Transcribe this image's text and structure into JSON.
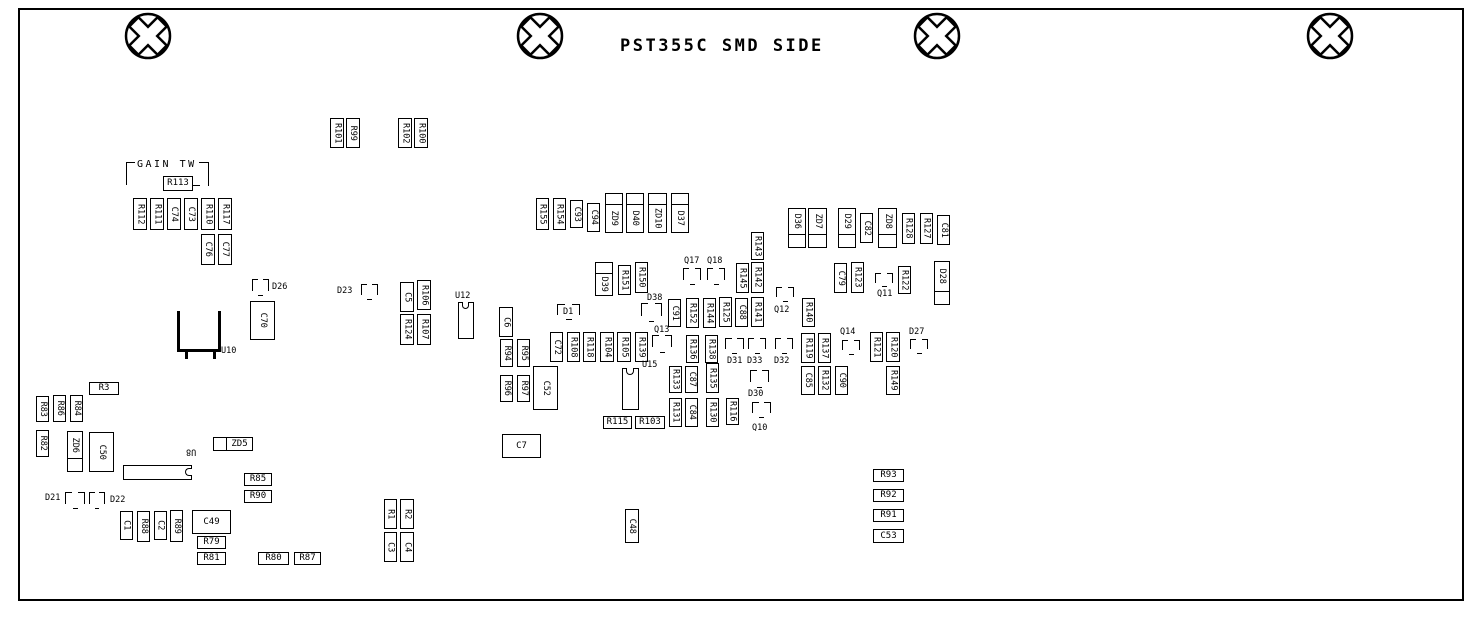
{
  "title": "PST355C SMD SIDE",
  "screws": [
    {
      "cx": 148,
      "cy": 36
    },
    {
      "cx": 540,
      "cy": 36
    },
    {
      "cx": 937,
      "cy": 36
    },
    {
      "cx": 1330,
      "cy": 36
    }
  ],
  "annotations": {
    "gain_tw": "GAIN TW"
  },
  "components": [
    {
      "t": "txt",
      "label": "GAIN TW",
      "x": 137,
      "y": 160,
      "fs": 10,
      "ls": 2.5
    },
    {
      "t": "cl",
      "ref": "gain-tw-bracket-left",
      "x": 126,
      "y": 162,
      "w": 9,
      "h": 23
    },
    {
      "t": "cr",
      "ref": "gain-tw-bracket-right",
      "x": 199,
      "y": 162,
      "w": 10,
      "h": 24
    },
    {
      "t": "ln",
      "ref": "gain-tw-bracket-arm",
      "x": 192,
      "y": 185,
      "w": 8,
      "h": 1
    },
    {
      "t": "bh",
      "label": "R113",
      "x": 163,
      "y": 176,
      "w": 30,
      "h": 15
    },
    {
      "t": "bv",
      "label": "R101",
      "x": 330,
      "y": 118,
      "w": 14,
      "h": 30
    },
    {
      "t": "bv",
      "label": "R99",
      "x": 346,
      "y": 118,
      "w": 14,
      "h": 30
    },
    {
      "t": "bv",
      "label": "R102",
      "x": 398,
      "y": 118,
      "w": 14,
      "h": 30
    },
    {
      "t": "bv",
      "label": "R100",
      "x": 414,
      "y": 118,
      "w": 14,
      "h": 30
    },
    {
      "t": "bv",
      "label": "R112",
      "x": 133,
      "y": 198,
      "w": 14,
      "h": 32
    },
    {
      "t": "bv",
      "label": "R111",
      "x": 150,
      "y": 198,
      "w": 14,
      "h": 32
    },
    {
      "t": "bv",
      "label": "C74",
      "x": 167,
      "y": 198,
      "w": 14,
      "h": 32
    },
    {
      "t": "bv",
      "label": "C73",
      "x": 184,
      "y": 198,
      "w": 14,
      "h": 32
    },
    {
      "t": "bv",
      "label": "R110",
      "x": 201,
      "y": 198,
      "w": 14,
      "h": 32
    },
    {
      "t": "bv",
      "label": "R117",
      "x": 218,
      "y": 198,
      "w": 14,
      "h": 32
    },
    {
      "t": "bv",
      "label": "C76",
      "x": 201,
      "y": 234,
      "w": 14,
      "h": 31
    },
    {
      "t": "bv",
      "label": "C77",
      "x": 218,
      "y": 234,
      "w": 14,
      "h": 31
    },
    {
      "t": "brk",
      "ref": "D26",
      "x": 252,
      "y": 279,
      "w": 17,
      "h": 17
    },
    {
      "t": "txt",
      "label": "D26",
      "x": 272,
      "y": 283
    },
    {
      "t": "bv",
      "label": "C70",
      "x": 250,
      "y": 301,
      "w": 25,
      "h": 39
    },
    {
      "t": "u10",
      "ref": "U10",
      "x": 177,
      "y": 311,
      "w": 44,
      "h": 41
    },
    {
      "t": "txt",
      "label": "U10",
      "x": 221,
      "y": 347
    },
    {
      "t": "txt",
      "label": "D23",
      "x": 337,
      "y": 287
    },
    {
      "t": "brk",
      "ref": "D23",
      "x": 361,
      "y": 284,
      "w": 17,
      "h": 16
    },
    {
      "t": "bv",
      "label": "C5",
      "x": 400,
      "y": 282,
      "w": 14,
      "h": 30
    },
    {
      "t": "bv",
      "label": "R106",
      "x": 417,
      "y": 280,
      "w": 14,
      "h": 30
    },
    {
      "t": "bv",
      "label": "R124",
      "x": 400,
      "y": 314,
      "w": 14,
      "h": 31
    },
    {
      "t": "bv",
      "label": "R107",
      "x": 417,
      "y": 314,
      "w": 14,
      "h": 31
    },
    {
      "t": "txt",
      "label": "U12",
      "x": 455,
      "y": 292
    },
    {
      "t": "icV",
      "ref": "U12",
      "x": 458,
      "y": 302,
      "w": 16,
      "h": 37
    },
    {
      "t": "bh",
      "label": "R3",
      "x": 89,
      "y": 382,
      "w": 30,
      "h": 13
    },
    {
      "t": "bv",
      "label": "R83",
      "x": 36,
      "y": 396,
      "w": 13,
      "h": 26
    },
    {
      "t": "bv",
      "label": "R86",
      "x": 53,
      "y": 395,
      "w": 13,
      "h": 27
    },
    {
      "t": "bv",
      "label": "R84",
      "x": 70,
      "y": 395,
      "w": 13,
      "h": 27
    },
    {
      "t": "bv",
      "label": "R82",
      "x": 36,
      "y": 430,
      "w": 13,
      "h": 27
    },
    {
      "t": "dv",
      "label": "ZD6",
      "x": 67,
      "y": 431,
      "w": 16,
      "h": 41
    },
    {
      "t": "bv",
      "label": "C50",
      "x": 89,
      "y": 432,
      "w": 25,
      "h": 40
    },
    {
      "t": "icH",
      "ref": "U8",
      "x": 123,
      "y": 465,
      "w": 69,
      "h": 15
    },
    {
      "t": "txtv",
      "label": "U8",
      "x": 186,
      "y": 447
    },
    {
      "t": "dh",
      "label": "ZD5",
      "x": 213,
      "y": 437,
      "w": 40,
      "h": 14
    },
    {
      "t": "txt",
      "label": "D21",
      "x": 45,
      "y": 494
    },
    {
      "t": "brk",
      "ref": "D21",
      "x": 65,
      "y": 492,
      "w": 20,
      "h": 17
    },
    {
      "t": "brk",
      "ref": "D22",
      "x": 89,
      "y": 492,
      "w": 16,
      "h": 17
    },
    {
      "t": "txt",
      "label": "D22",
      "x": 110,
      "y": 496
    },
    {
      "t": "bv",
      "label": "C1",
      "x": 120,
      "y": 511,
      "w": 13,
      "h": 29
    },
    {
      "t": "bv",
      "label": "R88",
      "x": 137,
      "y": 511,
      "w": 13,
      "h": 31
    },
    {
      "t": "bv",
      "label": "C2",
      "x": 154,
      "y": 511,
      "w": 13,
      "h": 29
    },
    {
      "t": "bv",
      "label": "R89",
      "x": 170,
      "y": 510,
      "w": 13,
      "h": 32
    },
    {
      "t": "bh",
      "label": "C49",
      "x": 192,
      "y": 510,
      "w": 39,
      "h": 24
    },
    {
      "t": "bh",
      "label": "R79",
      "x": 197,
      "y": 536,
      "w": 29,
      "h": 13
    },
    {
      "t": "bh",
      "label": "R81",
      "x": 197,
      "y": 552,
      "w": 29,
      "h": 13
    },
    {
      "t": "bh",
      "label": "R80",
      "x": 258,
      "y": 552,
      "w": 31,
      "h": 13
    },
    {
      "t": "bh",
      "label": "R87",
      "x": 294,
      "y": 552,
      "w": 27,
      "h": 13
    },
    {
      "t": "bh",
      "label": "R85",
      "x": 244,
      "y": 473,
      "w": 28,
      "h": 13
    },
    {
      "t": "bh",
      "label": "R90",
      "x": 244,
      "y": 490,
      "w": 28,
      "h": 13
    },
    {
      "t": "bv",
      "label": "R1",
      "x": 384,
      "y": 499,
      "w": 13,
      "h": 30
    },
    {
      "t": "bv",
      "label": "R2",
      "x": 400,
      "y": 499,
      "w": 14,
      "h": 30
    },
    {
      "t": "bv",
      "label": "C3",
      "x": 384,
      "y": 532,
      "w": 13,
      "h": 30
    },
    {
      "t": "bv",
      "label": "C4",
      "x": 400,
      "y": 532,
      "w": 14,
      "h": 30
    },
    {
      "t": "bh",
      "label": "C7",
      "x": 502,
      "y": 434,
      "w": 39,
      "h": 24
    },
    {
      "t": "bv",
      "label": "C48",
      "x": 625,
      "y": 509,
      "w": 14,
      "h": 34
    },
    {
      "t": "bv",
      "label": "R155",
      "x": 536,
      "y": 198,
      "w": 13,
      "h": 32
    },
    {
      "t": "bv",
      "label": "R154",
      "x": 553,
      "y": 198,
      "w": 13,
      "h": 32
    },
    {
      "t": "bv",
      "label": "C93",
      "x": 570,
      "y": 200,
      "w": 13,
      "h": 28
    },
    {
      "t": "bv",
      "label": "C94",
      "x": 587,
      "y": 203,
      "w": 13,
      "h": 29
    },
    {
      "t": "dvb",
      "label": "ZD9",
      "x": 605,
      "y": 193,
      "w": 18,
      "h": 40
    },
    {
      "t": "dvb",
      "label": "D40",
      "x": 626,
      "y": 193,
      "w": 18,
      "h": 40
    },
    {
      "t": "dvb",
      "label": "ZD10",
      "x": 648,
      "y": 193,
      "w": 19,
      "h": 40
    },
    {
      "t": "dvb",
      "label": "D37",
      "x": 671,
      "y": 193,
      "w": 18,
      "h": 40
    },
    {
      "t": "dvb",
      "label": "D39",
      "x": 595,
      "y": 262,
      "w": 18,
      "h": 34
    },
    {
      "t": "bv",
      "label": "R151",
      "x": 618,
      "y": 265,
      "w": 13,
      "h": 30
    },
    {
      "t": "bv",
      "label": "R150",
      "x": 635,
      "y": 262,
      "w": 13,
      "h": 31
    },
    {
      "t": "txt",
      "label": "D38",
      "x": 647,
      "y": 294
    },
    {
      "t": "brk",
      "ref": "D38",
      "x": 641,
      "y": 303,
      "w": 21,
      "h": 19
    },
    {
      "t": "txt",
      "label": "Q17",
      "x": 684,
      "y": 257
    },
    {
      "t": "brk",
      "ref": "Q17",
      "x": 683,
      "y": 268,
      "w": 18,
      "h": 17
    },
    {
      "t": "txt",
      "label": "Q18",
      "x": 707,
      "y": 257
    },
    {
      "t": "brk",
      "ref": "Q18",
      "x": 707,
      "y": 268,
      "w": 18,
      "h": 17
    },
    {
      "t": "bv",
      "label": "C91",
      "x": 668,
      "y": 299,
      "w": 13,
      "h": 28
    },
    {
      "t": "bv",
      "label": "R152",
      "x": 686,
      "y": 298,
      "w": 13,
      "h": 30
    },
    {
      "t": "bv",
      "label": "R144",
      "x": 703,
      "y": 298,
      "w": 13,
      "h": 30
    },
    {
      "t": "bv",
      "label": "R125",
      "x": 719,
      "y": 297,
      "w": 13,
      "h": 30
    },
    {
      "t": "bv",
      "label": "C88",
      "x": 735,
      "y": 298,
      "w": 13,
      "h": 29
    },
    {
      "t": "bv",
      "label": "R141",
      "x": 751,
      "y": 297,
      "w": 13,
      "h": 30
    },
    {
      "t": "bv",
      "label": "R143",
      "x": 751,
      "y": 232,
      "w": 13,
      "h": 28
    },
    {
      "t": "bv",
      "label": "R145",
      "x": 736,
      "y": 263,
      "w": 13,
      "h": 30
    },
    {
      "t": "bv",
      "label": "R142",
      "x": 751,
      "y": 262,
      "w": 13,
      "h": 31
    },
    {
      "t": "brk",
      "ref": "Q12",
      "x": 776,
      "y": 287,
      "w": 18,
      "h": 15
    },
    {
      "t": "txt",
      "label": "Q12",
      "x": 774,
      "y": 306
    },
    {
      "t": "bv",
      "label": "R140",
      "x": 802,
      "y": 298,
      "w": 13,
      "h": 29
    },
    {
      "t": "bv",
      "label": "C79",
      "x": 834,
      "y": 263,
      "w": 13,
      "h": 30
    },
    {
      "t": "bv",
      "label": "R123",
      "x": 851,
      "y": 262,
      "w": 13,
      "h": 31
    },
    {
      "t": "brk",
      "ref": "Q11",
      "x": 875,
      "y": 273,
      "w": 18,
      "h": 14
    },
    {
      "t": "txt",
      "label": "Q11",
      "x": 877,
      "y": 290
    },
    {
      "t": "bv",
      "label": "R122",
      "x": 898,
      "y": 266,
      "w": 13,
      "h": 28
    },
    {
      "t": "dv",
      "label": "D28",
      "x": 934,
      "y": 261,
      "w": 16,
      "h": 44
    },
    {
      "t": "dv",
      "label": "D36",
      "x": 788,
      "y": 208,
      "w": 18,
      "h": 40
    },
    {
      "t": "dv",
      "label": "ZD7",
      "x": 808,
      "y": 208,
      "w": 19,
      "h": 40
    },
    {
      "t": "dv",
      "label": "D29",
      "x": 838,
      "y": 208,
      "w": 18,
      "h": 40
    },
    {
      "t": "bv",
      "label": "C82",
      "x": 860,
      "y": 213,
      "w": 13,
      "h": 30
    },
    {
      "t": "dv",
      "label": "ZD8",
      "x": 878,
      "y": 208,
      "w": 19,
      "h": 40
    },
    {
      "t": "bv",
      "label": "R128",
      "x": 902,
      "y": 213,
      "w": 13,
      "h": 31
    },
    {
      "t": "bv",
      "label": "R127",
      "x": 920,
      "y": 213,
      "w": 13,
      "h": 31
    },
    {
      "t": "bv",
      "label": "C81",
      "x": 937,
      "y": 215,
      "w": 13,
      "h": 30
    },
    {
      "t": "bv",
      "label": "C6",
      "x": 499,
      "y": 307,
      "w": 14,
      "h": 30
    },
    {
      "t": "brk",
      "ref": "D1",
      "x": 557,
      "y": 304,
      "w": 23,
      "h": 16
    },
    {
      "t": "txt",
      "label": "D1",
      "x": 563,
      "y": 308
    },
    {
      "t": "bv",
      "label": "R94",
      "x": 500,
      "y": 339,
      "w": 13,
      "h": 28
    },
    {
      "t": "bv",
      "label": "R95",
      "x": 517,
      "y": 339,
      "w": 13,
      "h": 28
    },
    {
      "t": "bv",
      "label": "R96",
      "x": 500,
      "y": 375,
      "w": 13,
      "h": 27
    },
    {
      "t": "bv",
      "label": "R97",
      "x": 517,
      "y": 375,
      "w": 13,
      "h": 27
    },
    {
      "t": "bv",
      "label": "C72",
      "x": 550,
      "y": 332,
      "w": 13,
      "h": 30
    },
    {
      "t": "bv",
      "label": "R108",
      "x": 567,
      "y": 332,
      "w": 13,
      "h": 30
    },
    {
      "t": "bv",
      "label": "R118",
      "x": 583,
      "y": 332,
      "w": 13,
      "h": 30
    },
    {
      "t": "bv",
      "label": "R104",
      "x": 600,
      "y": 332,
      "w": 14,
      "h": 30
    },
    {
      "t": "bv",
      "label": "R105",
      "x": 617,
      "y": 332,
      "w": 14,
      "h": 30
    },
    {
      "t": "bv",
      "label": "R139",
      "x": 635,
      "y": 332,
      "w": 13,
      "h": 30
    },
    {
      "t": "bv",
      "label": "C52",
      "x": 533,
      "y": 366,
      "w": 25,
      "h": 44
    },
    {
      "t": "icV",
      "ref": "U15",
      "x": 622,
      "y": 368,
      "w": 17,
      "h": 42
    },
    {
      "t": "txt",
      "label": "U15",
      "x": 642,
      "y": 361
    },
    {
      "t": "txt",
      "label": "Q13",
      "x": 654,
      "y": 326
    },
    {
      "t": "brk",
      "ref": "Q13",
      "x": 652,
      "y": 335,
      "w": 20,
      "h": 18
    },
    {
      "t": "bv",
      "label": "R136",
      "x": 686,
      "y": 335,
      "w": 13,
      "h": 28
    },
    {
      "t": "bv",
      "label": "R138",
      "x": 705,
      "y": 335,
      "w": 13,
      "h": 28
    },
    {
      "t": "brk",
      "ref": "D31",
      "x": 725,
      "y": 338,
      "w": 19,
      "h": 16
    },
    {
      "t": "txt",
      "label": "D31",
      "x": 727,
      "y": 357
    },
    {
      "t": "brk",
      "ref": "D33",
      "x": 748,
      "y": 338,
      "w": 18,
      "h": 16
    },
    {
      "t": "txt",
      "label": "D33",
      "x": 747,
      "y": 357
    },
    {
      "t": "brk",
      "ref": "D32",
      "x": 775,
      "y": 338,
      "w": 18,
      "h": 16
    },
    {
      "t": "txt",
      "label": "D32",
      "x": 774,
      "y": 357
    },
    {
      "t": "brk",
      "ref": "D30",
      "x": 750,
      "y": 370,
      "w": 19,
      "h": 18
    },
    {
      "t": "txt",
      "label": "D30",
      "x": 748,
      "y": 390
    },
    {
      "t": "bv",
      "label": "R133",
      "x": 669,
      "y": 366,
      "w": 13,
      "h": 27
    },
    {
      "t": "bv",
      "label": "C87",
      "x": 685,
      "y": 366,
      "w": 13,
      "h": 27
    },
    {
      "t": "bv",
      "label": "R135",
      "x": 706,
      "y": 363,
      "w": 13,
      "h": 30
    },
    {
      "t": "bv",
      "label": "R131",
      "x": 669,
      "y": 398,
      "w": 13,
      "h": 29
    },
    {
      "t": "bv",
      "label": "C84",
      "x": 685,
      "y": 398,
      "w": 13,
      "h": 29
    },
    {
      "t": "bv",
      "label": "R130",
      "x": 706,
      "y": 398,
      "w": 13,
      "h": 29
    },
    {
      "t": "bv",
      "label": "R116",
      "x": 726,
      "y": 398,
      "w": 13,
      "h": 27
    },
    {
      "t": "brk",
      "ref": "Q10",
      "x": 752,
      "y": 402,
      "w": 19,
      "h": 16
    },
    {
      "t": "txt",
      "label": "Q10",
      "x": 752,
      "y": 424
    },
    {
      "t": "bh",
      "label": "R115",
      "x": 603,
      "y": 416,
      "w": 29,
      "h": 13
    },
    {
      "t": "bh",
      "label": "R103",
      "x": 635,
      "y": 416,
      "w": 30,
      "h": 13
    },
    {
      "t": "bv",
      "label": "R119",
      "x": 801,
      "y": 333,
      "w": 14,
      "h": 30
    },
    {
      "t": "bv",
      "label": "R137",
      "x": 818,
      "y": 333,
      "w": 13,
      "h": 30
    },
    {
      "t": "txt",
      "label": "Q14",
      "x": 840,
      "y": 328
    },
    {
      "t": "brk",
      "ref": "Q14",
      "x": 842,
      "y": 340,
      "w": 18,
      "h": 15
    },
    {
      "t": "bv",
      "label": "R121",
      "x": 870,
      "y": 332,
      "w": 13,
      "h": 30
    },
    {
      "t": "bv",
      "label": "R120",
      "x": 886,
      "y": 332,
      "w": 14,
      "h": 30
    },
    {
      "t": "txt",
      "label": "D27",
      "x": 909,
      "y": 328
    },
    {
      "t": "brk",
      "ref": "D27",
      "x": 910,
      "y": 339,
      "w": 18,
      "h": 15
    },
    {
      "t": "bv",
      "label": "C85",
      "x": 801,
      "y": 366,
      "w": 14,
      "h": 29
    },
    {
      "t": "bv",
      "label": "R132",
      "x": 818,
      "y": 366,
      "w": 13,
      "h": 29
    },
    {
      "t": "bv",
      "label": "C90",
      "x": 835,
      "y": 366,
      "w": 13,
      "h": 29
    },
    {
      "t": "bv",
      "label": "R149",
      "x": 886,
      "y": 366,
      "w": 14,
      "h": 29
    },
    {
      "t": "bh",
      "label": "R93",
      "x": 873,
      "y": 469,
      "w": 31,
      "h": 13
    },
    {
      "t": "bh",
      "label": "R92",
      "x": 873,
      "y": 489,
      "w": 31,
      "h": 13
    },
    {
      "t": "bh",
      "label": "R91",
      "x": 873,
      "y": 509,
      "w": 31,
      "h": 13
    },
    {
      "t": "bh",
      "label": "C53",
      "x": 873,
      "y": 529,
      "w": 31,
      "h": 14
    }
  ]
}
